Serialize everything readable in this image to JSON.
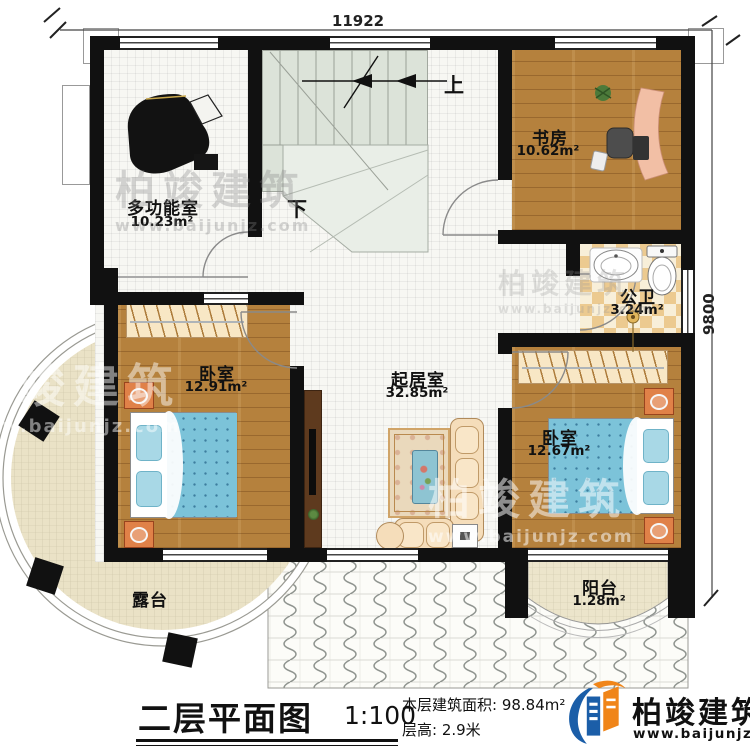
{
  "dimensions": {
    "top": "11922",
    "right": "9800"
  },
  "rooms": {
    "multi": {
      "name": "多功能室",
      "area": "10.23m²"
    },
    "study": {
      "name": "书房",
      "area": "10.62m²"
    },
    "bath": {
      "name": "公卫",
      "area": "3.24m²"
    },
    "bedroom_left": {
      "name": "卧室",
      "area": "12.91m²"
    },
    "living": {
      "name": "起居室",
      "area": "32.85m²"
    },
    "bedroom_right": {
      "name": "卧室",
      "area": "12.67m²"
    },
    "terrace": {
      "name": "露台"
    },
    "balcony": {
      "name": "阳台",
      "area": "1.28m²"
    }
  },
  "stairs": {
    "up": "上",
    "down": "下"
  },
  "title_block": {
    "title": "二层平面图",
    "scale": "1:100",
    "floor_area": "本层建筑面积: 98.84m²",
    "floor_height": "层高: 2.9米"
  },
  "brand": {
    "name": "柏竣建筑",
    "website": "www.baijunjz.com"
  },
  "watermark": {
    "name": "柏竣建筑",
    "website": "www.baijunjz.com"
  },
  "colors": {
    "wall": "#111111",
    "wood_floor": "#b5813d",
    "bath_tile": "#ecca90",
    "stair": "#dce3d9",
    "terrace_tile": "#eae2c6",
    "bed_blue": "#7cc3d9",
    "nightstand_orange": "#e08148",
    "brand_blue": "#1b5ea8",
    "brand_orange": "#f08519"
  }
}
